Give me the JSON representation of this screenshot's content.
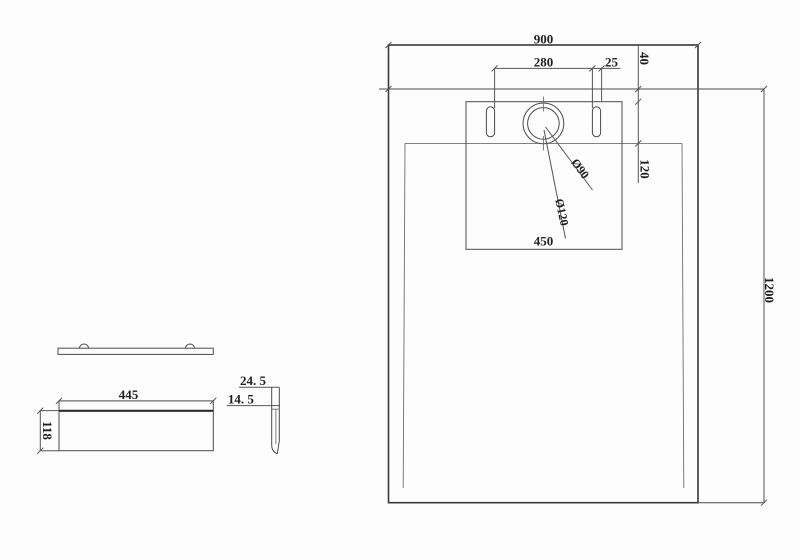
{
  "drawing": {
    "kind": "technical-drawing shower tray",
    "colors": {
      "background": "#fdfdfd",
      "line": "#4a4a4a",
      "line_bold": "#3a3a3a",
      "line_light": "#6f6f6f",
      "text": "#1f1f1f"
    },
    "top_view": {
      "overall_width": "900",
      "overall_length": "1200",
      "slot_spacing": "280",
      "slot_width": "25",
      "flange_depth": "40",
      "drain_offset": "120",
      "drain_zone_width": "450",
      "drain_outer_dia": "Ø120",
      "drain_inner_dia": "Ø90"
    },
    "front_view": {
      "panel_width": "445",
      "panel_height": "118"
    },
    "detail_view": {
      "outer_lip_height": "24. 5",
      "inner_lip_height": "14. 5"
    }
  }
}
